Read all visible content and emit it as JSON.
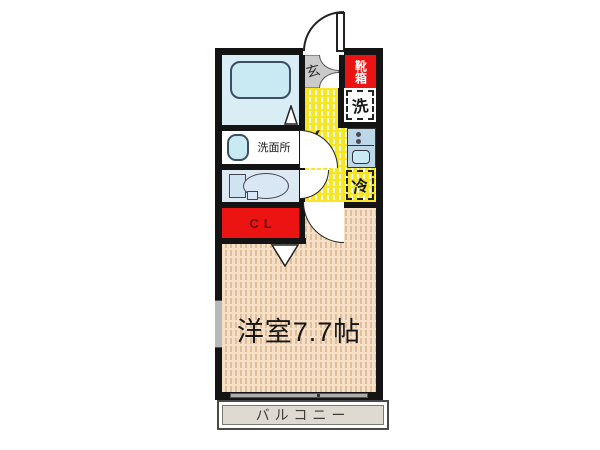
{
  "floorplan": {
    "labels": {
      "entrance": "玄",
      "shoe_box": "靴箱",
      "washer": "洗",
      "fridge": "冷",
      "kitchen": "K",
      "washroom": "洗面所",
      "closet": "CL",
      "main_room": "洋室7.7帖",
      "balcony": "バルコニー"
    },
    "colors": {
      "wall": "#141414",
      "accent_red": "#ec1313",
      "closet_text": "#6b1111",
      "kitchen_yellow": "#f6e624",
      "room_tan": "#f6dfc4",
      "fixture_blue": "#c9e9f3",
      "fixture_bg": "#d9edf5",
      "toilet_bg": "#dde9f2",
      "counter_blue": "#bcd8e8",
      "balcony_gray": "#dedad2",
      "genkan_gray": "#cbcbcb"
    }
  }
}
